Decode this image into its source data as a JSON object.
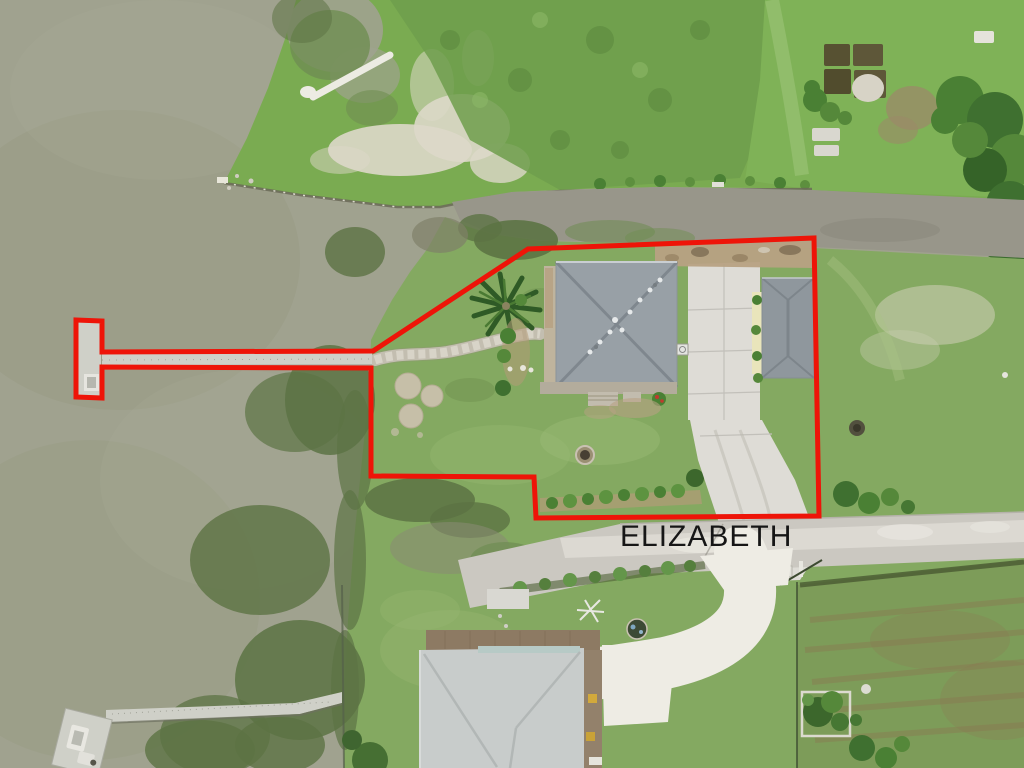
{
  "street_label": {
    "text": "ELIZABETH"
  },
  "property_boundary": {
    "color": "#ee1408",
    "stroke_px": 5,
    "description": "red outline of waterfront lot including long pier with T-head platform"
  },
  "scene": {
    "type": "aerial-drone-photo",
    "features": {
      "bay": "murky sage-green open water, left side",
      "canal": "gray water channel across upper right",
      "main_house": "square gray hip roof with X ridge lines",
      "garage": "small gray hip roof with pale yellow awning strip",
      "neighbor_house": "light gray roof at bottom center with wood deck",
      "pier": "long narrow dock from lot to T-head platform in bay",
      "second_dock": "lower-left dock with boat lift",
      "road": "light gray gravel road labeled ELIZABETH"
    }
  },
  "colors": {
    "water": "#a0a28f",
    "water_shade": "#96987f",
    "canal": "#98968a",
    "marsh_dark": "#5c7344",
    "marsh_mid": "#6f8d52",
    "bank_green": "#7aab51",
    "lawn": "#84a961",
    "lawn_light": "#9dbe78",
    "scrub": "#6f9e4c",
    "field": "#7d9c59",
    "sand": "#ddd8c9",
    "dirt": "#9b8a68",
    "road": "#cbc8c1",
    "road_light": "#e2e0d8",
    "concrete": "#dedcd6",
    "white_drive": "#eeece4",
    "roof_main": "#98a0a6",
    "roof_ridge": "#7a8289",
    "roof_garage": "#8f979d",
    "awning_yellow": "#e9e5bb",
    "roof_neighbor": "#c8cccb",
    "deck_wood": "#8d7a63",
    "dock": "#cfd0c8",
    "tree_dark": "#3f7030",
    "tree_mid": "#55883a",
    "bush": "#4a8034",
    "mulch": "#b49b78",
    "gravel": "#b7a183",
    "bulkhead": "#6b6a58",
    "fence": "#3c4a30",
    "boundary_red": "#ee1408",
    "label_black": "#161616"
  }
}
